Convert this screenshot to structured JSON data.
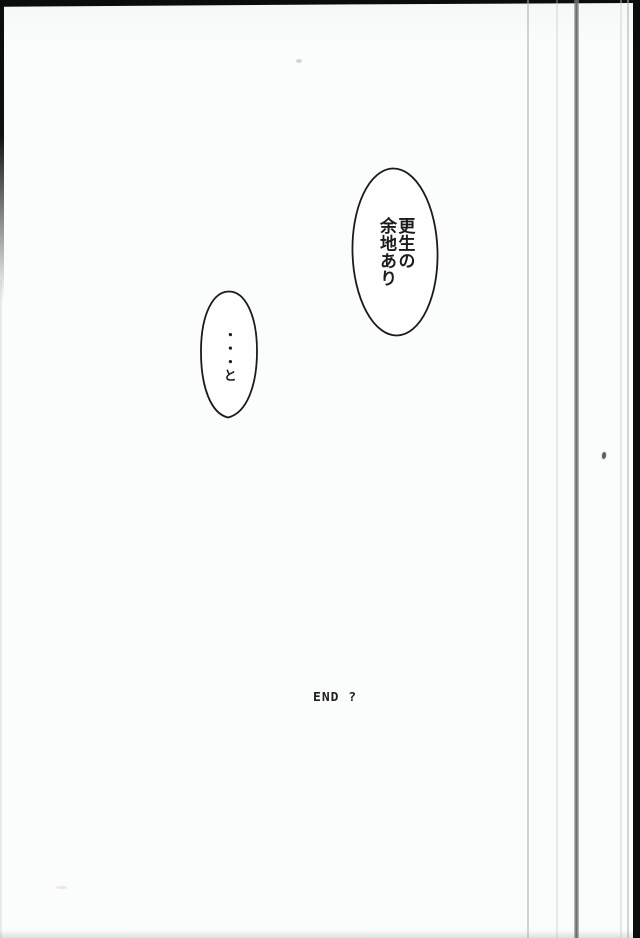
{
  "manga_page": {
    "speech_bubbles": [
      {
        "name": "bubble-right",
        "text": "更生の\n余地あり"
      },
      {
        "name": "bubble-left",
        "text": "・・・と"
      }
    ],
    "end_label": "END ?",
    "colors": {
      "paper": "#fbfdfc",
      "ink": "#1c1c1c",
      "frame_black": "#0b0d0c",
      "page_edge_dark": "#5f6763",
      "page_edge_light": "#ccd3cf"
    }
  }
}
